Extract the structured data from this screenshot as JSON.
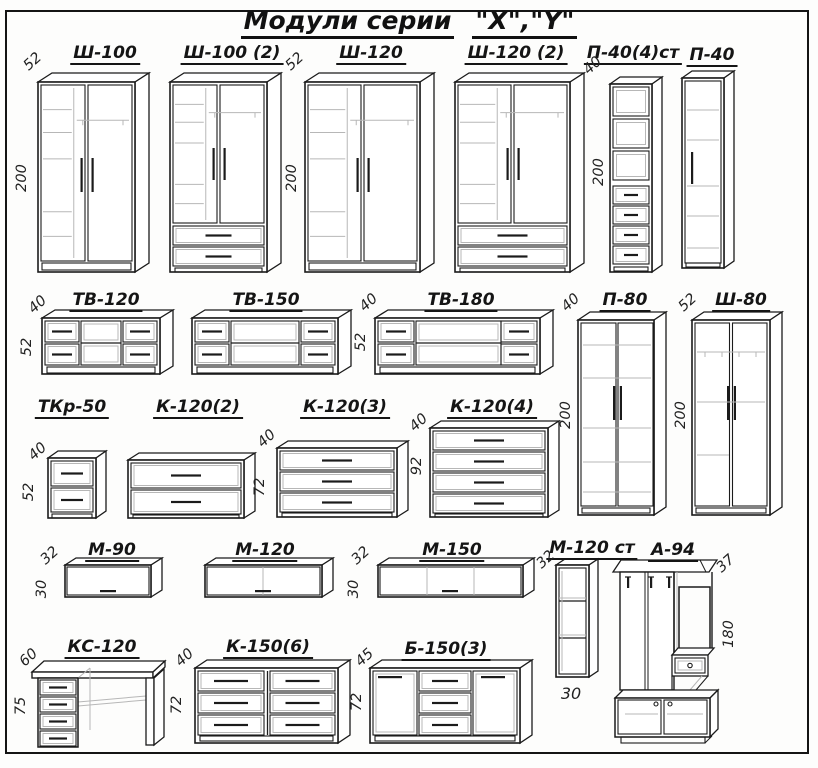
{
  "title": {
    "part1": "Модули серии",
    "part2": "\"X\",\"Y\""
  },
  "modules": {
    "sh100": {
      "label": "Ш-100",
      "depth": "52",
      "height": "200"
    },
    "sh100_2": {
      "label": "Ш-100 (2)"
    },
    "sh120": {
      "label": "Ш-120",
      "depth": "52",
      "height": "200"
    },
    "sh120_2": {
      "label": "Ш-120 (2)"
    },
    "p40_4st": {
      "label": "П-40(4)ст",
      "depth": "40",
      "height": "200"
    },
    "p40": {
      "label": "П-40"
    },
    "tv120": {
      "label": "ТВ-120",
      "depth": "40",
      "height": "52"
    },
    "tv150": {
      "label": "ТВ-150"
    },
    "tv180": {
      "label": "ТВ-180",
      "depth": "40",
      "height": "52"
    },
    "p80": {
      "label": "П-80",
      "depth": "40",
      "height": "200"
    },
    "sh80": {
      "label": "Ш-80",
      "depth": "52",
      "height": "200"
    },
    "tkr50": {
      "label": "ТКр-50",
      "depth": "40",
      "height": "52"
    },
    "k120_2": {
      "label": "К-120(2)"
    },
    "k120_3": {
      "label": "К-120(3)",
      "depth": "40",
      "height": "72"
    },
    "k120_4": {
      "label": "К-120(4)",
      "depth": "40",
      "height": "92"
    },
    "m90": {
      "label": "М-90",
      "depth": "32",
      "height": "30"
    },
    "m120": {
      "label": "М-120"
    },
    "m150": {
      "label": "М-150",
      "depth": "32",
      "height": "30"
    },
    "m120st": {
      "label": "М-120 ст",
      "depth": "32",
      "width_bottom": "30"
    },
    "a94": {
      "label": "А-94",
      "depth": "37",
      "height": "180"
    },
    "ks120": {
      "label": "КС-120",
      "depth": "60",
      "height": "75"
    },
    "k150_6": {
      "label": "К-150(6)",
      "depth": "40",
      "height": "72"
    },
    "b150_3": {
      "label": "Б-150(3)",
      "depth": "45",
      "height": "72"
    }
  }
}
